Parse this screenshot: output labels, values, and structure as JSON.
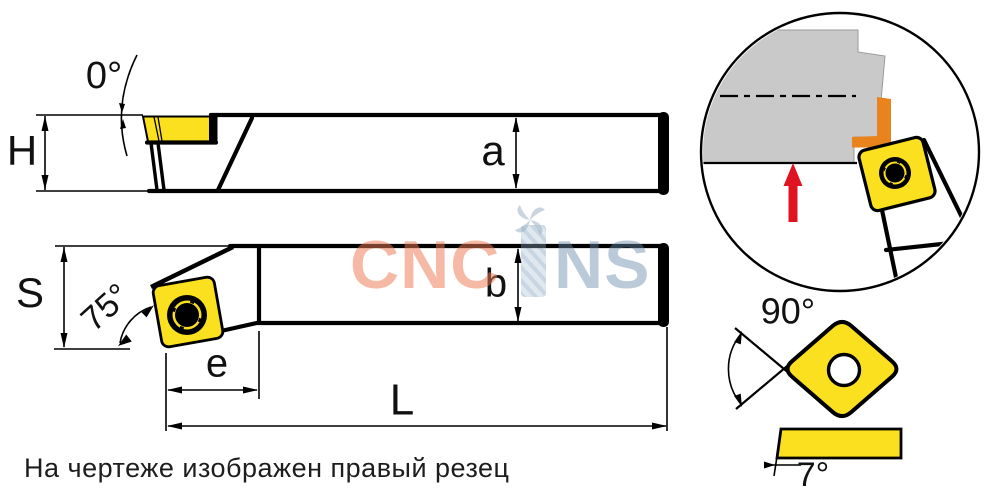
{
  "note": "На чертеже изображен правый резец",
  "watermark": {
    "prefix": "CNC",
    "suffix": "NS"
  },
  "dimensions": {
    "rake_angle": "0°",
    "holder_height": "H",
    "seat_height": "a",
    "head_width": "S",
    "approach_angle": "75°",
    "head_length": "e",
    "shank_width": "b",
    "total_length": "L",
    "insert_point_angle": "90°",
    "insert_clearance_angle": "7°"
  },
  "colors": {
    "insert_yellow": "#FAE01E",
    "workpiece_gray": "#C9C9C9",
    "chip_orange": "#E8831D",
    "feed_arrow_red": "#DF1420",
    "line_black": "#000000"
  }
}
